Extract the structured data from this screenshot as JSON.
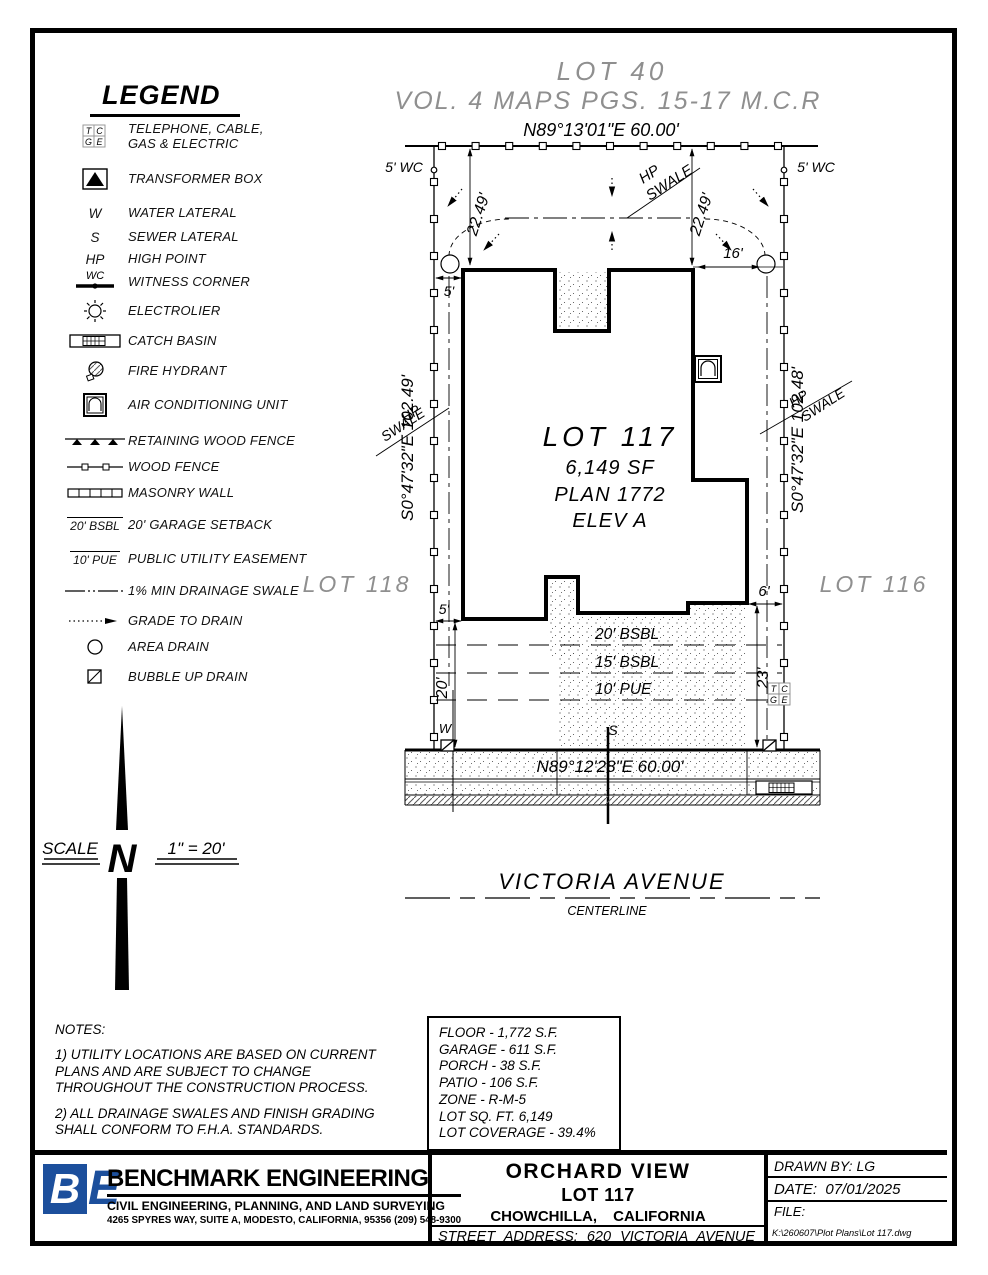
{
  "legend": {
    "title": "LEGEND",
    "items": [
      {
        "label": "TELEPHONE, CABLE,\nGAS & ELECTRIC"
      },
      {
        "label": "TRANSFORMER BOX"
      },
      {
        "sym": "W",
        "label": "WATER LATERAL"
      },
      {
        "sym": "S",
        "label": "SEWER LATERAL"
      },
      {
        "sym": "HP",
        "label": "HIGH POINT"
      },
      {
        "sym": "WC",
        "label": "WITNESS CORNER"
      },
      {
        "label": "ELECTROLIER"
      },
      {
        "label": "CATCH BASIN"
      },
      {
        "label": "FIRE HYDRANT"
      },
      {
        "label": "AIR CONDITIONING UNIT"
      },
      {
        "label": "RETAINING WOOD FENCE"
      },
      {
        "label": "WOOD FENCE"
      },
      {
        "label": "MASONRY WALL"
      },
      {
        "sym": "20' BSBL",
        "label": "20' GARAGE SETBACK"
      },
      {
        "sym": "10' PUE",
        "label": "PUBLIC UTILITY EASEMENT"
      },
      {
        "label": "1% MIN DRAINAGE SWALE"
      },
      {
        "label": "GRADE TO DRAIN"
      },
      {
        "label": "AREA DRAIN"
      },
      {
        "label": "BUBBLE UP DRAIN"
      }
    ]
  },
  "tcge": {
    "t": "T",
    "c": "C",
    "g": "G",
    "e": "E"
  },
  "plot": {
    "adjacent_lot_top": "LOT 40",
    "map_ref": "VOL. 4 MAPS PGS. 15-17 M.C.R",
    "bearing_top": "N89°13'01\"E  60.00'",
    "bearing_bottom": "N89°12'28\"E  60.00'",
    "bearing_left": "S0°47'32\"E  102.49'",
    "bearing_right": "S0°47'32\"E  102.48'",
    "wc_left": "5' WC",
    "wc_right": "5' WC",
    "lot_number": "LOT 117",
    "lot_area": "6,149 SF",
    "plan": "PLAN 1772",
    "elevation": "ELEV A",
    "lot_left": "LOT 118",
    "lot_right": "LOT 116",
    "dim_left_22": "22.49'",
    "dim_right_22": "22.49'",
    "dim_16": "16'",
    "dim_5_top": "5'",
    "dim_5_bottom": "5'",
    "dim_20": "20'",
    "dim_23": "23'",
    "dim_6": "6'",
    "hp": "HP",
    "swale": "SWALE",
    "setback_20": "20' BSBL",
    "setback_15": "15' BSBL",
    "pue_10": "10' PUE",
    "water": "W",
    "sewer": "S",
    "street_name": "VICTORIA AVENUE",
    "street_sub": "CENTERLINE"
  },
  "compass": {
    "north": "N"
  },
  "scale": {
    "label": "SCALE",
    "value": "1\" = 20'"
  },
  "notes": {
    "title": "NOTES:",
    "note1": "1) UTILITY LOCATIONS ARE BASED ON CURRENT PLANS AND ARE SUBJECT TO CHANGE THROUGHOUT THE CONSTRUCTION PROCESS.",
    "note2": "2) ALL DRAINAGE SWALES AND FINISH GRADING SHALL CONFORM TO F.H.A. STANDARDS."
  },
  "area_table": {
    "rows": [
      "FLOOR - 1,772 S.F.",
      "GARAGE - 611 S.F.",
      "PORCH - 38 S.F.",
      "PATIO - 106 S.F.",
      "ZONE - R-M-5",
      "LOT SQ. FT. 6,149",
      "LOT COVERAGE - 39.4%"
    ]
  },
  "title_block": {
    "logo_b": "B",
    "logo_e": "E",
    "company": "BENCHMARK ENGINEERING",
    "tagline": "CIVIL ENGINEERING, PLANNING, AND LAND SURVEYING",
    "address": "4265 SPYRES WAY, SUITE A, MODESTO, CALIFORNIA, 95356    (209) 548-9300",
    "project": "ORCHARD VIEW",
    "lot": "LOT 117",
    "city": "CHOWCHILLA,  CALIFORNIA",
    "street_address": "STREET  ADDRESS:  620  VICTORIA  AVENUE",
    "drawn_by_label": "DRAWN BY:",
    "drawn_by": "LG",
    "date_label": "DATE:",
    "date": "07/01/2025",
    "file_label": "FILE:",
    "file_path": "K:\\260607\\Plot Plans\\Lot 117.dwg"
  },
  "colors": {
    "accent_blue": "#1c4f9c",
    "faded_gray": "#8f8f8f"
  }
}
